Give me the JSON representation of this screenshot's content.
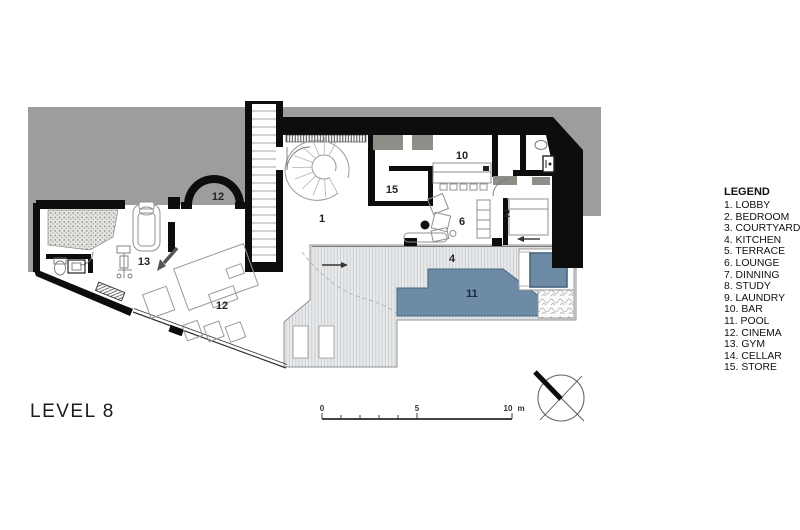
{
  "title": "LEVEL 8",
  "legend": {
    "heading": "LEGEND",
    "items": [
      {
        "label": "1. LOBBY"
      },
      {
        "label": "2. BEDROOM"
      },
      {
        "label": "3. COURTYARD"
      },
      {
        "label": "4. KITCHEN"
      },
      {
        "label": "5. TERRACE"
      },
      {
        "label": "6. LOUNGE"
      },
      {
        "label": "7. DINNING"
      },
      {
        "label": "8. STUDY"
      },
      {
        "label": "9. LAUNDRY"
      },
      {
        "label": "10. BAR"
      },
      {
        "label": "11. POOL"
      },
      {
        "label": "12. CINEMA"
      },
      {
        "label": "13. GYM"
      },
      {
        "label": "14. CELLAR"
      },
      {
        "label": "15. STORE"
      }
    ]
  },
  "plan": {
    "labels": [
      {
        "room": "lobby",
        "text": "1"
      },
      {
        "room": "bedroom",
        "text": "2"
      },
      {
        "room": "kitchen-terrace",
        "text": "4"
      },
      {
        "room": "lounge",
        "text": "6"
      },
      {
        "room": "bar",
        "text": "10"
      },
      {
        "room": "pool",
        "text": "11"
      },
      {
        "room": "cinema-upper",
        "text": "12"
      },
      {
        "room": "cinema",
        "text": "12"
      },
      {
        "room": "gym",
        "text": "13"
      },
      {
        "room": "store",
        "text": "15"
      }
    ]
  },
  "scale_bar": {
    "zero": "0",
    "five": "5",
    "ten": "10",
    "unit": "m"
  },
  "colors": {
    "pool_blue": "#6d8ba6",
    "pool_edge": "#48677f",
    "backdrop_gray": "#9d9d9d",
    "wall_black": "#0d0d0d",
    "terrace_base": "#e9eaeb"
  },
  "icons": {
    "north_arrow": "north-arrow-compass"
  }
}
